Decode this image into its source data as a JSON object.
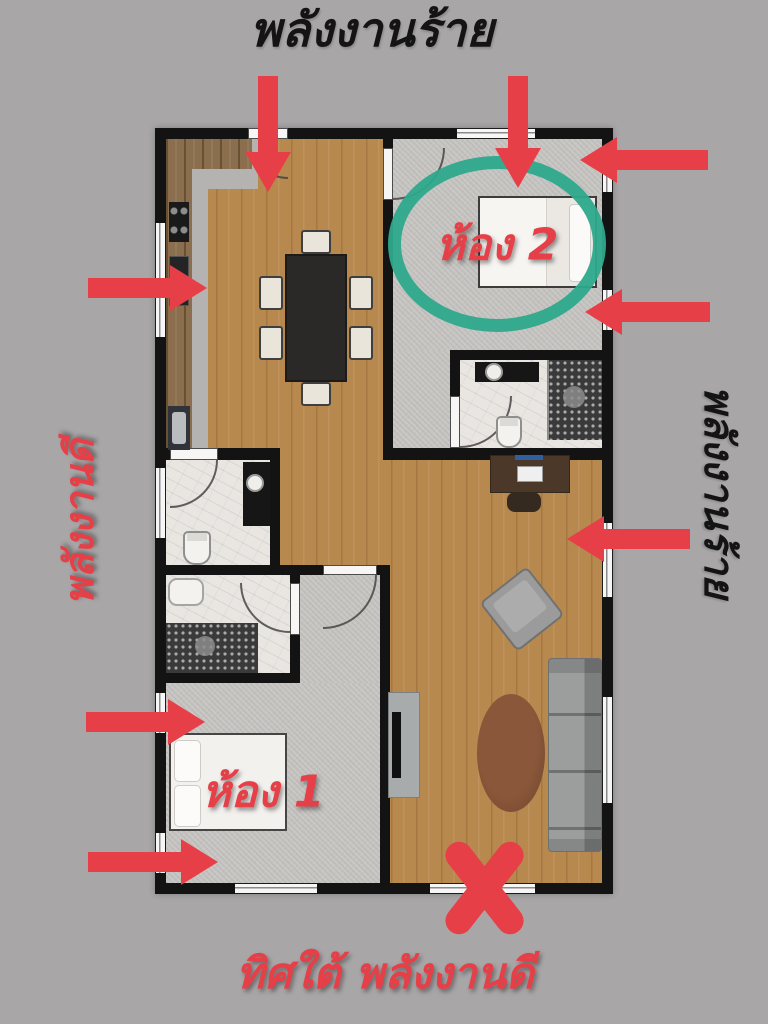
{
  "labels": {
    "top_title": "พลังงานร้าย",
    "left_side": "พลังงานดี",
    "right_side": "พลังงานร้าย",
    "bottom_caption": "ทิศใต้ พลังงานดี",
    "room_1": "ห้อง 1",
    "room_2": "ห้อง 2"
  },
  "colors": {
    "background": "#a8a6a7",
    "annotation_red": "#e73f47",
    "circle_teal": "#2ea98c",
    "title_black": "#141414",
    "wall_black": "#131313",
    "wood_floor": "#b8894e",
    "carpet_gray": "#c8c6c3",
    "marble": "#e9e6e2",
    "kitchen_floor": "#b5b3b1"
  },
  "annotations": {
    "circle": {
      "shape": "ellipse",
      "color": "#2ea98c",
      "encloses": "ห้อง 2"
    },
    "x_mark": {
      "shape": "X",
      "color": "#e73f47",
      "position": "bottom wall opening"
    },
    "arrows": [
      {
        "direction": "down",
        "position": "top wall entry door"
      },
      {
        "direction": "down",
        "position": "top wall of room 2"
      },
      {
        "direction": "left",
        "position": "upper right into room 2"
      },
      {
        "direction": "left",
        "position": "right into room 2"
      },
      {
        "direction": "right",
        "position": "left into kitchen"
      },
      {
        "direction": "left",
        "position": "right into living area"
      },
      {
        "direction": "right",
        "position": "left into room 1 (upper)"
      },
      {
        "direction": "right",
        "position": "left into room 1 (lower)"
      }
    ]
  },
  "floorplan": {
    "rooms": [
      "kitchen-dining",
      "bedroom-2",
      "ensuite-bathroom",
      "powder-room",
      "bathroom",
      "bedroom-1",
      "living-room"
    ]
  }
}
